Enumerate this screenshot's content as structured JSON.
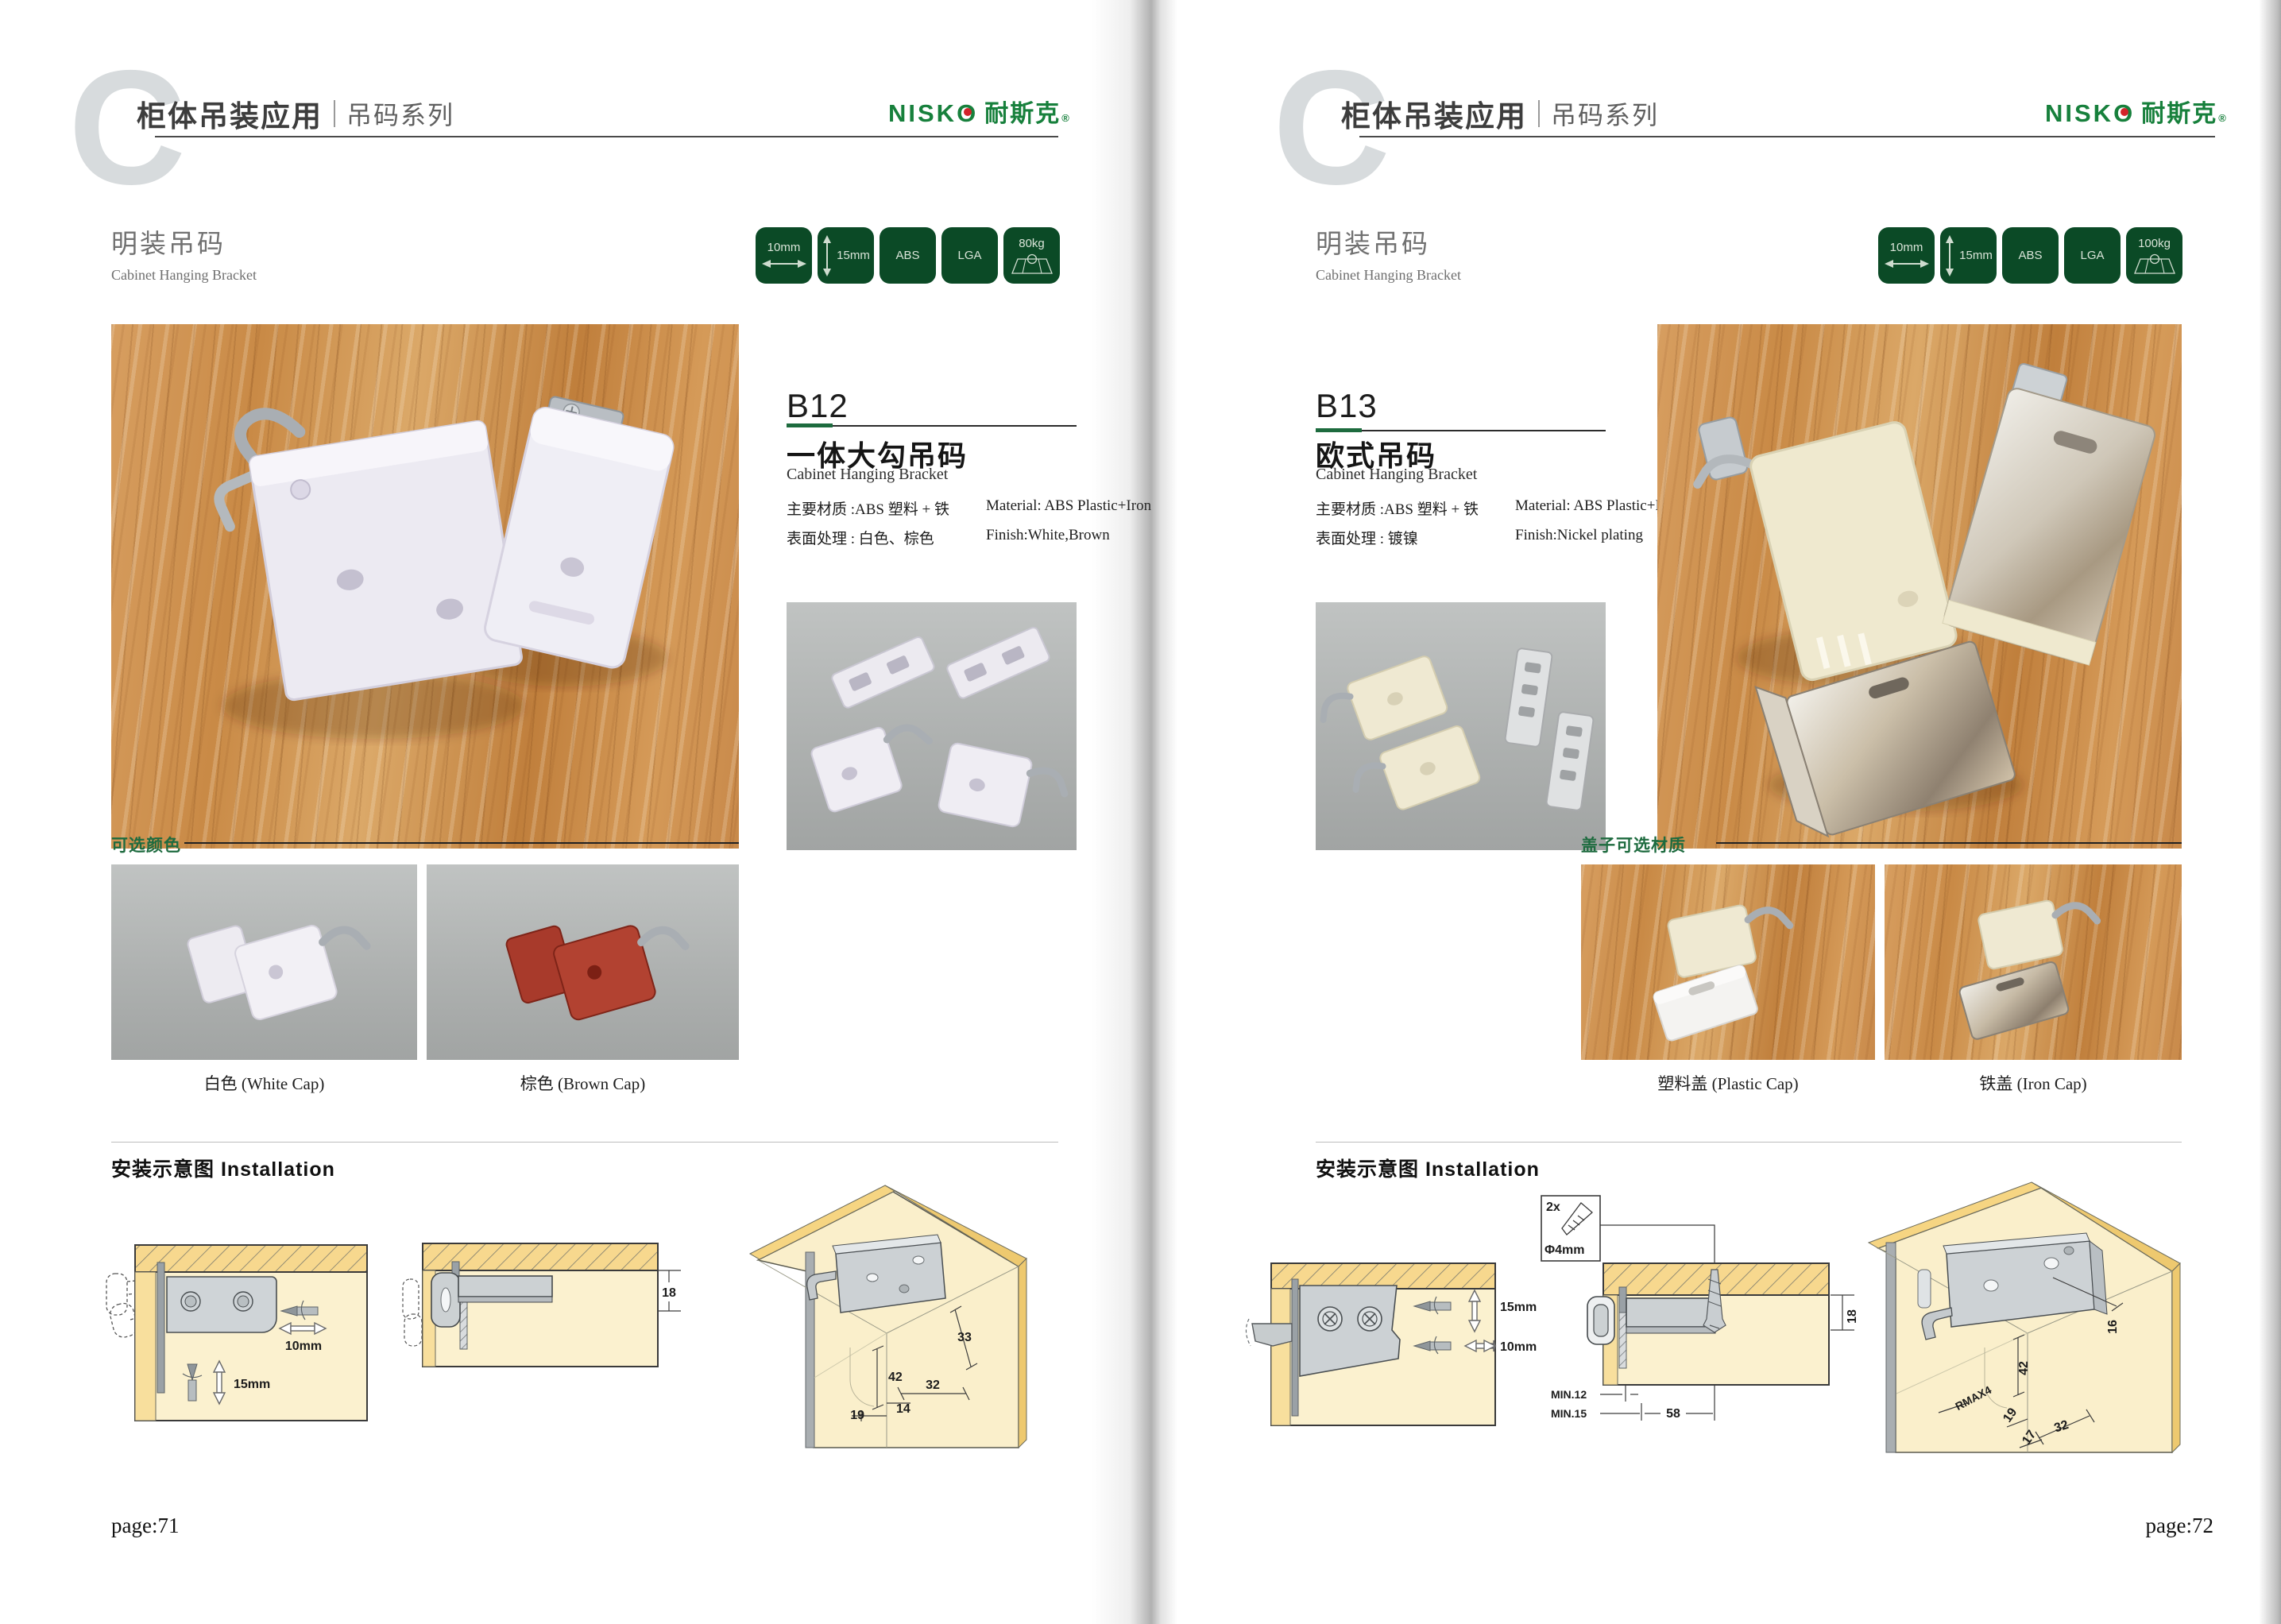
{
  "colors": {
    "badge_green": "#0b4a26",
    "brand_green": "#17803c",
    "brand_red_dot": "#d2232a",
    "accent_rule_green": "#1d6b3e",
    "option_label_green": "#1e6b3f",
    "brown_cap_red": "#9e3427"
  },
  "pages": [
    {
      "page_letter": "C",
      "header": {
        "title": "柜体吊装应用",
        "series": "吊码系列",
        "brand_latin": "NISKO",
        "brand_cn": "耐斯克",
        "brand_reg": "®"
      },
      "section": {
        "title_cn": "明装吊码",
        "title_en": "Cabinet Hanging Bracket"
      },
      "badges": [
        {
          "label": "10mm",
          "icon": "width-arrow"
        },
        {
          "label": "15mm",
          "icon": "height-arrow"
        },
        {
          "label": "ABS",
          "icon": "none"
        },
        {
          "label": "LGA",
          "icon": "none"
        },
        {
          "label": "80kg",
          "icon": "load"
        }
      ],
      "product": {
        "code": "B12",
        "name_cn": "一体大勾吊码",
        "name_en": "Cabinet Hanging Bracket",
        "specs": [
          {
            "cn": "主要材质 :ABS 塑料 + 铁",
            "en": "Material: ABS Plastic+Iron"
          },
          {
            "cn": "表面处理 : 白色、棕色",
            "en": "Finish:White,Brown"
          }
        ]
      },
      "options": {
        "heading": "可选颜色",
        "items": [
          {
            "caption": "白色 (White Cap)"
          },
          {
            "caption": "棕色 (Brown Cap)"
          }
        ]
      },
      "installation": {
        "heading": "安装示意图 Installation",
        "front_view": {
          "width": "10mm",
          "height": "15mm"
        },
        "side_view": {
          "thickness": "18"
        },
        "iso_view": {
          "d1": "33",
          "d2": "42",
          "d3": "32",
          "d4": "14",
          "d5": "19"
        }
      },
      "page_label": "page:71"
    },
    {
      "page_letter": "C",
      "header": {
        "title": "柜体吊装应用",
        "series": "吊码系列",
        "brand_latin": "NISKO",
        "brand_cn": "耐斯克",
        "brand_reg": "®"
      },
      "section": {
        "title_cn": "明装吊码",
        "title_en": "Cabinet Hanging Bracket"
      },
      "badges": [
        {
          "label": "10mm",
          "icon": "width-arrow"
        },
        {
          "label": "15mm",
          "icon": "height-arrow"
        },
        {
          "label": "ABS",
          "icon": "none"
        },
        {
          "label": "LGA",
          "icon": "none"
        },
        {
          "label": "100kg",
          "icon": "load"
        }
      ],
      "product": {
        "code": "B13",
        "name_cn": "欧式吊码",
        "name_en": "Cabinet Hanging Bracket",
        "specs": [
          {
            "cn": "主要材质 :ABS 塑料 + 铁",
            "en": "Material: ABS Plastic+Iron"
          },
          {
            "cn": "表面处理 : 镀镍",
            "en": "Finish:Nickel plating"
          }
        ]
      },
      "options": {
        "heading": "盖子可选材质",
        "items": [
          {
            "caption": "塑料盖 (Plastic Cap)"
          },
          {
            "caption": "铁盖 (Iron Cap)"
          }
        ]
      },
      "installation": {
        "heading": "安装示意图 Installation",
        "front_view": {
          "height": "15mm",
          "width": "10mm"
        },
        "screw_note": {
          "count": "2x",
          "size": "Φ4mm"
        },
        "side_view": {
          "thickness": "18",
          "min_a": "MIN.12",
          "min_b": "MIN.15",
          "spacing": "58"
        },
        "iso_view": {
          "d1": "16",
          "d2": "42",
          "d3": "RMAX4",
          "d4": "19",
          "d5": "17",
          "d6": "32"
        }
      },
      "page_label": "page:72"
    }
  ]
}
